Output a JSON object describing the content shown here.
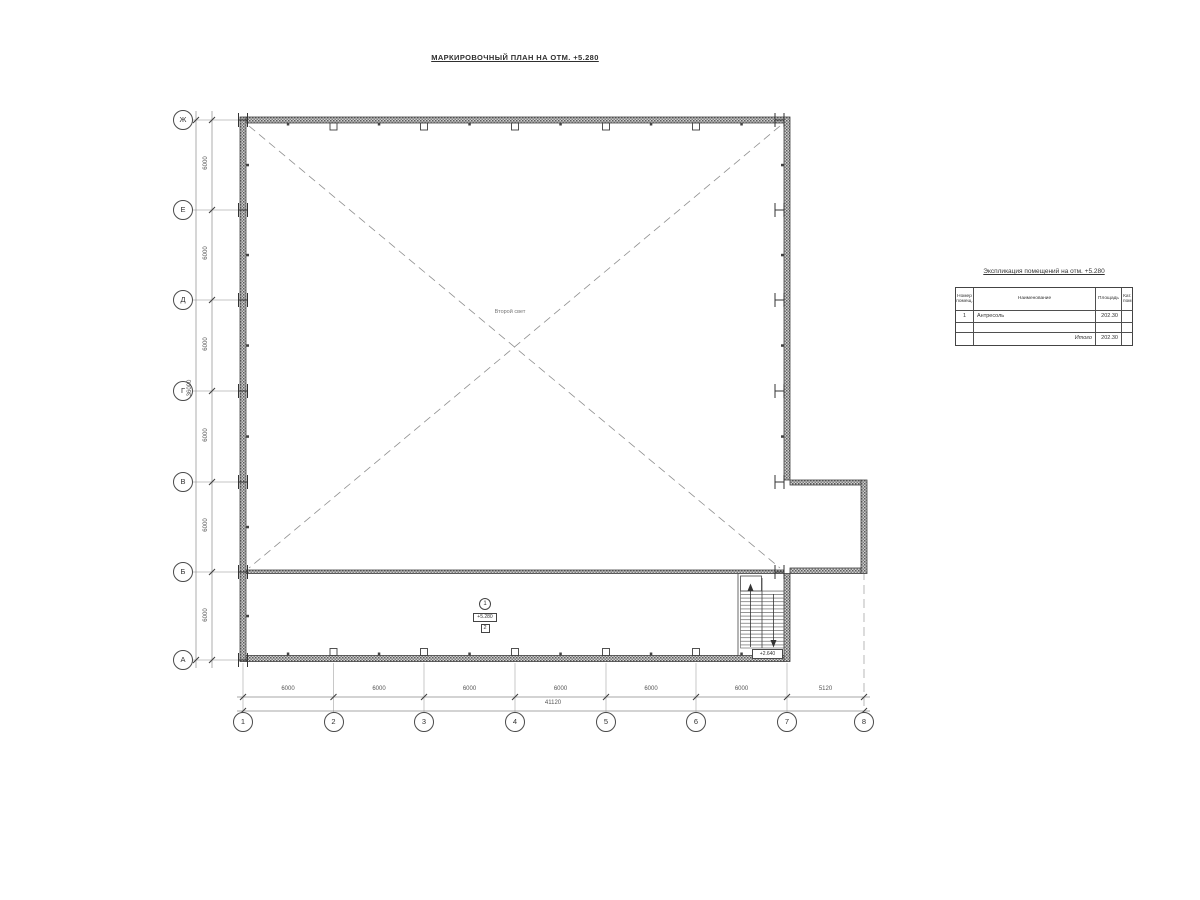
{
  "title": "МАРКИРОВОЧНЫЙ ПЛАН НА ОТМ. +5.280",
  "axes": {
    "left": [
      "Ж",
      "Е",
      "Д",
      "Г",
      "В",
      "Б",
      "А"
    ],
    "bottom": [
      "1",
      "2",
      "3",
      "4",
      "5",
      "6",
      "7",
      "8"
    ]
  },
  "dimensions": {
    "left_segments": [
      "6000",
      "6000",
      "6000",
      "6000",
      "6000",
      "6000"
    ],
    "left_total": "36000",
    "bottom_segments": [
      "6000",
      "6000",
      "6000",
      "6000",
      "6000",
      "6000",
      "5120"
    ],
    "bottom_total": "41120"
  },
  "plan": {
    "void_label": "Второй свет",
    "room_number": "1",
    "room_elevation": "+5.280",
    "room_category": "2",
    "stair_label": "+2.640"
  },
  "table": {
    "title": "Экспликация помещений на отм. +5.280",
    "headers": {
      "number": "Номер помещ.",
      "name": "Наименование",
      "area": "Площадь",
      "cat": "Кат. пом"
    },
    "rows": [
      {
        "number": "1",
        "name": "Антресоль",
        "area": "202.30",
        "cat": ""
      }
    ],
    "total_label": "Итого",
    "total_area": "202.30"
  },
  "colors": {
    "line": "#3f3f3f",
    "dimension": "#8a8a8a",
    "text": "#333333",
    "background": "#ffffff"
  }
}
